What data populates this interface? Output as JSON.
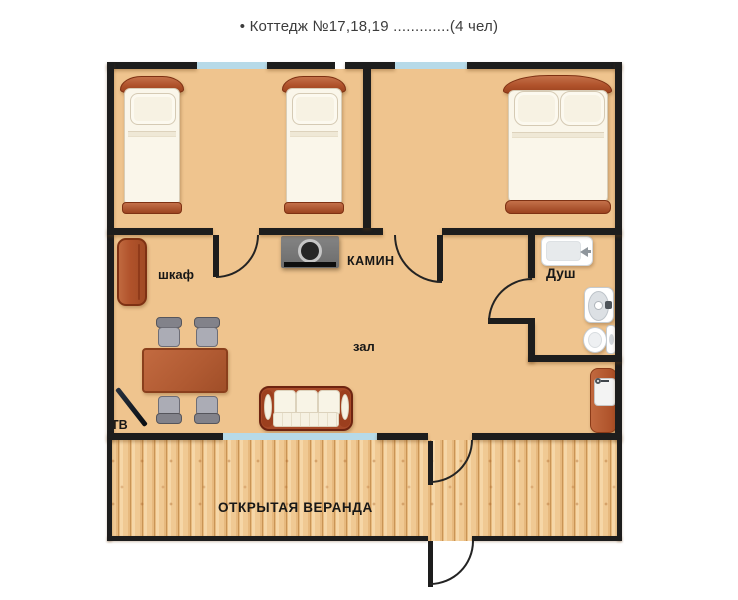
{
  "title": "• Коттедж №17,18,19 .............(4 чел)",
  "labels": {
    "wardrobe": "шкаф",
    "fireplace": "КАМИН",
    "shower": "Душ",
    "hall": "зал",
    "tv": "ТВ",
    "veranda": "ОТКРЫТАЯ  ВЕРАНДА"
  },
  "colors": {
    "wall": "#1d1d1d",
    "window": "#b7dae8",
    "floor_main": "#efc48e",
    "floor_veranda": "#f0c993",
    "furniture_wood": "#b0522b",
    "mattress": "#faf6ea",
    "fireplace_body": "#777777",
    "chair_gray": "#abacb5",
    "label_text": "#171717"
  }
}
